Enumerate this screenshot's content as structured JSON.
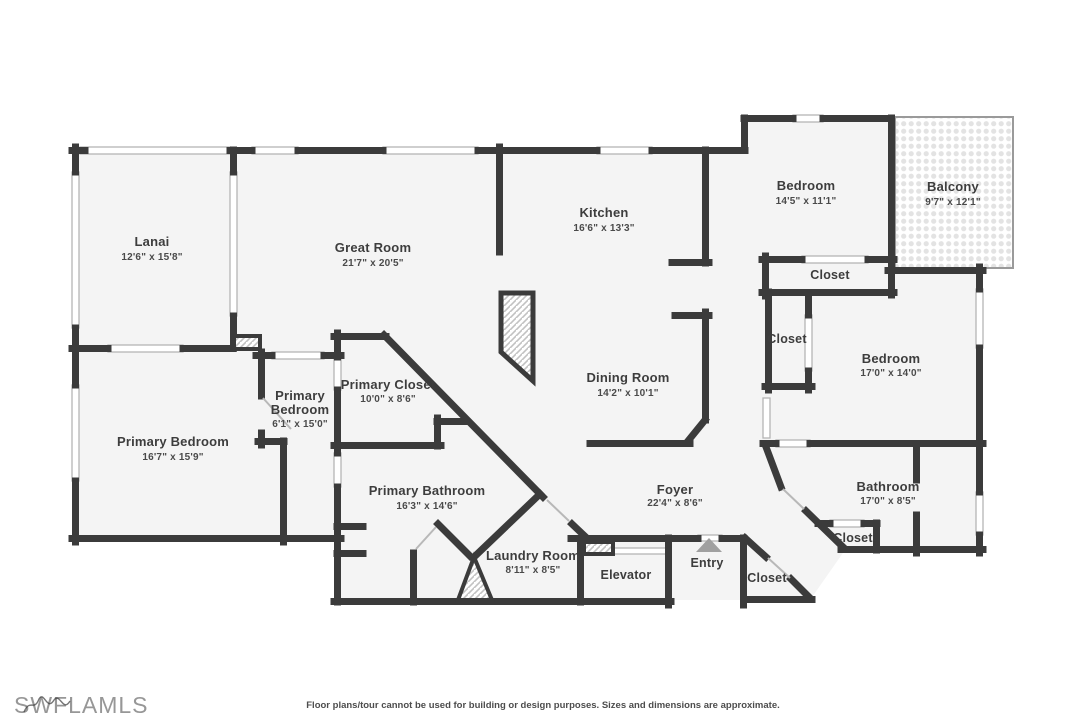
{
  "floorplan": {
    "rooms": {
      "lanai": {
        "name": "Lanai",
        "dims": "12'6\" x 15'8\""
      },
      "great_room": {
        "name": "Great Room",
        "dims": "21'7\" x 20'5\""
      },
      "kitchen": {
        "name": "Kitchen",
        "dims": "16'6\" x 13'3\""
      },
      "bedroom_ne": {
        "name": "Bedroom",
        "dims": "14'5\" x 11'1\""
      },
      "balcony": {
        "name": "Balcony",
        "dims": "9'7\" x 12'1\""
      },
      "bedroom_e": {
        "name": "Bedroom",
        "dims": "17'0\" x 14'0\""
      },
      "dining_room": {
        "name": "Dining Room",
        "dims": "14'2\" x 10'1\""
      },
      "primary_hall": {
        "line1": "Primary",
        "line2": "Bedroom",
        "dims": "6'1\" x 15'0\""
      },
      "primary_closet": {
        "name": "Primary Closet",
        "dims": "10'0\" x 8'6\""
      },
      "primary_bedroom": {
        "name": "Primary Bedroom",
        "dims": "16'7\" x 15'9\""
      },
      "primary_bathroom": {
        "name": "Primary Bathroom",
        "dims": "16'3\" x 14'6\""
      },
      "laundry_room": {
        "name": "Laundry Room",
        "dims": "8'11\" x 8'5\""
      },
      "foyer": {
        "name": "Foyer",
        "dims": "22'4\" x 8'6\""
      },
      "bathroom": {
        "name": "Bathroom",
        "dims": "17'0\" x 8'5\""
      },
      "closet_ne": {
        "name": "Closet"
      },
      "closet_e": {
        "name": "Closet"
      },
      "closet_foyer": {
        "name": "Closet"
      },
      "closet_bath": {
        "name": "Closet"
      },
      "elevator": {
        "name": "Elevator"
      },
      "entry": {
        "name": "Entry"
      }
    },
    "colors": {
      "wall": "#3b3b3b",
      "floor": "#f4f4f4",
      "thin_line": "#b5b5b5",
      "entry_arrow": "#a0a0a0"
    }
  },
  "branding": {
    "logo": "SWFLAMLS"
  },
  "footer": {
    "disclaimer": "Floor plans/tour cannot be used for building or design purposes. Sizes and dimensions are approximate."
  }
}
